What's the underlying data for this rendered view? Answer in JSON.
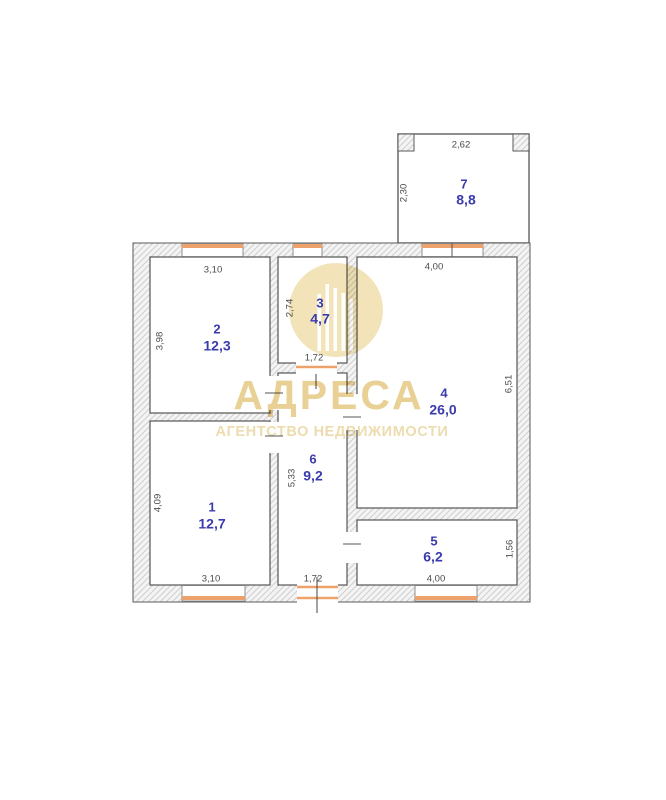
{
  "plan": {
    "rooms": [
      {
        "number": "1",
        "area": "12,7"
      },
      {
        "number": "2",
        "area": "12,3"
      },
      {
        "number": "3",
        "area": "4,7"
      },
      {
        "number": "4",
        "area": "26,0"
      },
      {
        "number": "5",
        "area": "6,2"
      },
      {
        "number": "6",
        "area": "9,2"
      },
      {
        "number": "7",
        "area": "8,8"
      }
    ],
    "dimensions": {
      "r1_h": "4,09",
      "r1_w": "3,10",
      "r2_w": "3,10",
      "r2_h": "3,98",
      "r3_h": "2,74",
      "r3_door": "1,72",
      "r4_w": "4,00",
      "r4_h": "6,51",
      "r5_w": "4,00",
      "r5_h": "1,56",
      "r6_h": "5,33",
      "r6_door": "1,72",
      "r7_w": "2,62",
      "r7_h": "2,30"
    }
  },
  "watermark": {
    "title": "АДРЕСА",
    "subtitle": "АГЕНТСТВО НЕДВИЖИМОСТИ"
  },
  "colors": {
    "room_label": "#3b3bae",
    "dimension_text": "#4a4a4a",
    "window": "#eda26b",
    "wall_line": "#5a5a5a",
    "watermark": "#e9d095"
  }
}
